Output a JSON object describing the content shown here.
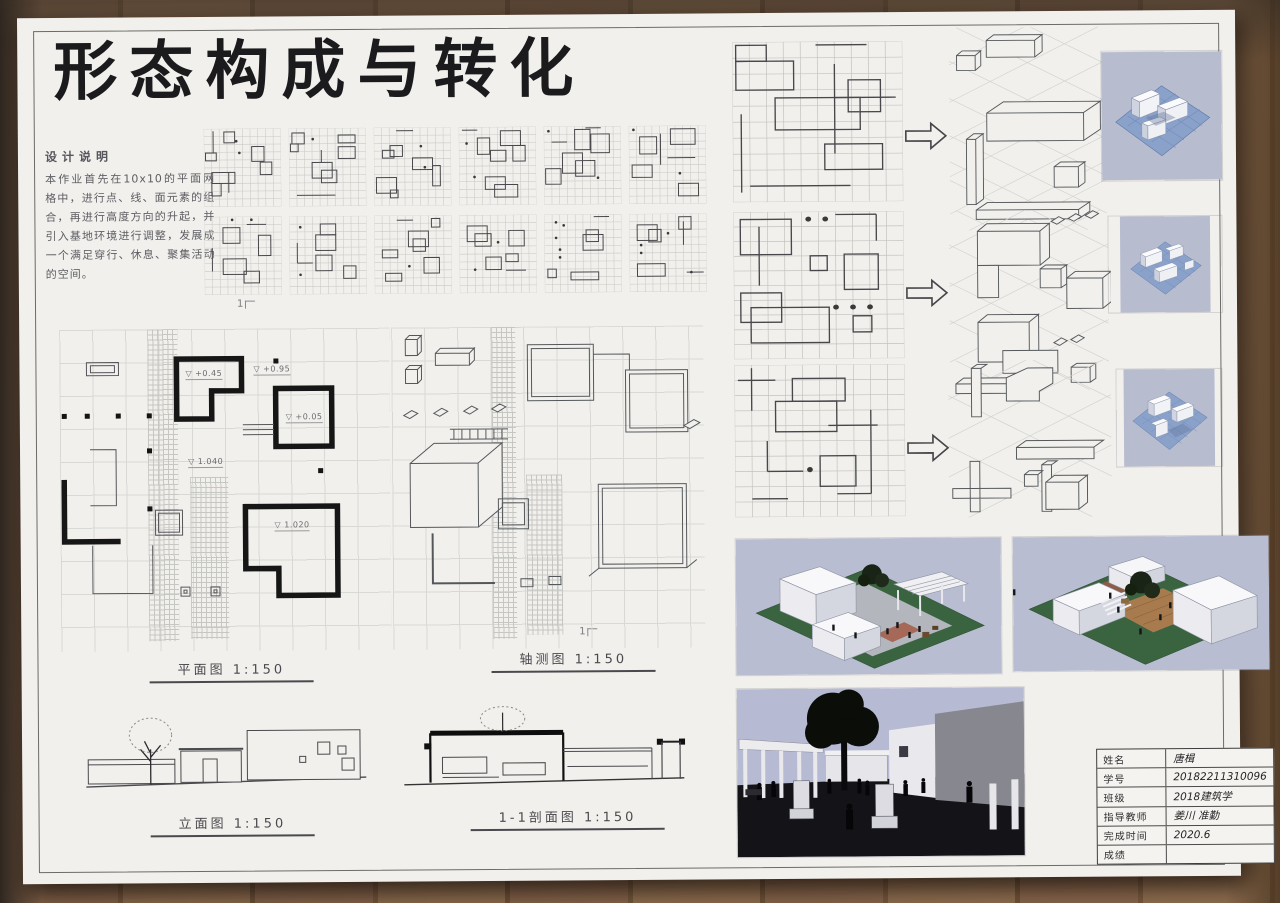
{
  "title": "形态构成与转化",
  "design_notes": {
    "heading": "设计说明",
    "body": "本作业首先在10x10的平面网格中，进行点、线、面元素的组合，再进行高度方向的升起，并引入基地环境进行调整，发展成一个满足穿行、休息、聚集活动的空间。"
  },
  "labels": {
    "plan": "平面图 1:150",
    "axon": "轴测图 1:150",
    "elevation": "立面图 1:150",
    "section": "1-1剖面图 1:150"
  },
  "plan": {
    "level_symbol": "▽",
    "section_marker": "1",
    "annotations": [
      {
        "text": "+0.45",
        "x": 126,
        "y": 40
      },
      {
        "text": "+0.95",
        "x": 194,
        "y": 36
      },
      {
        "text": "+0.05",
        "x": 226,
        "y": 84
      },
      {
        "text": "1.040",
        "x": 128,
        "y": 128
      },
      {
        "text": "1.020",
        "x": 214,
        "y": 192
      }
    ]
  },
  "title_block": {
    "rows": [
      {
        "label": "姓名",
        "value": "唐楫"
      },
      {
        "label": "学号",
        "value": "20182211310096"
      },
      {
        "label": "班级",
        "value": "2018建筑学"
      },
      {
        "label": "指导教师",
        "value": "姜川  准勤"
      },
      {
        "label": "完成时间",
        "value": "2020.6"
      },
      {
        "label": "成绩",
        "value": ""
      }
    ]
  },
  "grid_studies": {
    "rows": [
      [
        {
          "rects": [
            [
              2.6,
              0.4,
              1.4,
              1.4
            ],
            [
              0.2,
              3.1,
              1.4,
              1
            ],
            [
              6.2,
              2.3,
              1.6,
              1.9
            ],
            [
              7.3,
              4.3,
              1.5,
              1.6
            ],
            [
              1,
              5.6,
              3,
              1.4
            ],
            [
              1,
              7,
              1.2,
              1.6
            ]
          ],
          "dots": [
            [
              4.2,
              1.6
            ],
            [
              4.6,
              3.1
            ]
          ],
          "lines": [
            [
              1.2,
              0.3,
              1.2,
              3.1
            ],
            [
              3.2,
              5.6,
              3.2,
              8.2
            ]
          ]
        },
        {
          "rects": [
            [
              0.4,
              0.6,
              1.6,
              1.4
            ],
            [
              0.2,
              2,
              1,
              1
            ],
            [
              6.4,
              0.9,
              2.2,
              1
            ],
            [
              6.4,
              2.4,
              2.2,
              1.5
            ],
            [
              3,
              4.4,
              2.6,
              2
            ],
            [
              4.2,
              5.4,
              2,
              1.6
            ]
          ],
          "dots": [
            [
              3.1,
              1.4
            ]
          ],
          "lines": [
            [
              1,
              8.6,
              6,
              8.6
            ],
            [
              4.2,
              2.8,
              4.2,
              4.4
            ]
          ]
        },
        {
          "rects": [
            [
              2.1,
              2.3,
              1.6,
              1.4
            ],
            [
              1.1,
              2.9,
              1.5,
              1
            ],
            [
              5,
              3.9,
              2.6,
              1.5
            ],
            [
              7.6,
              4.9,
              1,
              2.6
            ],
            [
              0.3,
              6.4,
              2.6,
              2
            ],
            [
              2.1,
              8,
              1,
              1
            ]
          ],
          "dots": [
            [
              6.1,
              2.4
            ],
            [
              6.6,
              5.1
            ]
          ],
          "lines": [
            [
              2.9,
              0.4,
              5.1,
              0.4
            ]
          ]
        },
        {
          "rects": [
            [
              5.4,
              0.5,
              2.6,
              1.9
            ],
            [
              2.4,
              1.4,
              1.6,
              2.1
            ],
            [
              4.1,
              3,
              2,
              1.4
            ],
            [
              7,
              2.4,
              1.6,
              2
            ],
            [
              3.4,
              6.4,
              2.6,
              1.6
            ],
            [
              4.6,
              7.4,
              3,
              1.6
            ]
          ],
          "dots": [
            [
              1,
              2.1
            ],
            [
              2,
              6.4
            ]
          ],
          "lines": [
            [
              0.4,
              0.4,
              2.4,
              0.4
            ]
          ]
        },
        {
          "rects": [
            [
              4,
              0.4,
              2,
              2.6
            ],
            [
              6.1,
              1,
              2.4,
              2.4
            ],
            [
              2.4,
              3.4,
              2.6,
              2.6
            ],
            [
              4.1,
              4.4,
              2.5,
              2
            ],
            [
              0.2,
              5.4,
              2,
              2
            ]
          ],
          "dots": [
            [
              0.6,
              0.6
            ],
            [
              7,
              6.6
            ]
          ],
          "lines": [
            [
              1,
              2,
              3,
              2
            ],
            [
              5.4,
              0.2,
              7.4,
              0.2
            ]
          ]
        },
        {
          "rects": [
            [
              5.4,
              0.4,
              3.2,
              2
            ],
            [
              1.4,
              1.4,
              2.2,
              2.2
            ],
            [
              0.4,
              5,
              2.6,
              1.6
            ],
            [
              6.4,
              7.4,
              2.6,
              1.6
            ]
          ],
          "dots": [
            [
              0.6,
              0.5
            ],
            [
              6.6,
              6.1
            ]
          ],
          "lines": [
            [
              4.1,
              1,
              4.1,
              5
            ],
            [
              5,
              4.1,
              8.6,
              4.1
            ]
          ]
        }
      ],
      [
        {
          "rects": [
            [
              2.4,
              1.4,
              2.2,
              2
            ],
            [
              7,
              2.4,
              1.6,
              2.6
            ],
            [
              2.4,
              5.4,
              3,
              2
            ],
            [
              5.1,
              7,
              2,
              1.5
            ]
          ],
          "dots": [
            [
              3.6,
              0.4
            ],
            [
              6.1,
              0.4
            ]
          ],
          "lines": [
            [
              5.5,
              1,
              8,
              1
            ],
            [
              1,
              4,
              1,
              7
            ]
          ]
        },
        {
          "rects": [
            [
              4,
              1,
              2,
              1.4
            ],
            [
              3.4,
              2.4,
              2.6,
              2
            ],
            [
              3.4,
              5,
              2.1,
              2
            ],
            [
              7,
              6.4,
              1.6,
              1.6
            ]
          ],
          "dots": [
            [
              1.4,
              1.4
            ],
            [
              1.4,
              7.5
            ]
          ],
          "lines": [
            [
              1,
              3.4,
              1,
              6
            ],
            [
              1,
              6,
              3,
              6
            ]
          ]
        },
        {
          "rects": [
            [
              7.4,
              0.4,
              1.1,
              1.1
            ],
            [
              4.4,
              2,
              2.6,
              2
            ],
            [
              5,
              3,
              1.6,
              1.6
            ],
            [
              1,
              4.4,
              2,
              1
            ],
            [
              6.4,
              5.4,
              2,
              2
            ],
            [
              1.4,
              7.4,
              2.1,
              1
            ]
          ],
          "dots": [
            [
              4.5,
              6.5
            ]
          ],
          "lines": [
            [
              2.9,
              0.6,
              5,
              0.6
            ]
          ]
        },
        {
          "rects": [
            [
              1,
              1.4,
              2.6,
              2
            ],
            [
              2,
              2.4,
              2.1,
              1.6
            ],
            [
              6.4,
              2,
              2,
              2
            ],
            [
              3.4,
              5.4,
              2,
              1.6
            ],
            [
              6,
              5,
              1.6,
              1
            ]
          ],
          "dots": [
            [
              5,
              3.5
            ],
            [
              2,
              7
            ]
          ],
          "lines": [
            [
              6,
              7.1,
              8.6,
              7.1
            ]
          ]
        },
        {
          "rects": [
            [
              5.4,
              2,
              1.6,
              1.5
            ],
            [
              5,
              2.6,
              2.6,
              2
            ],
            [
              0.4,
              7,
              1.1,
              1.1
            ],
            [
              3.4,
              7.4,
              3.6,
              1
            ]
          ],
          "dots": [
            [
              1.5,
              1
            ],
            [
              2.5,
              1.4
            ],
            [
              1.5,
              3
            ],
            [
              2,
              4.5
            ],
            [
              2,
              5.5
            ]
          ],
          "lines": [
            [
              6.4,
              0.3,
              8.4,
              0.3
            ]
          ]
        },
        {
          "rects": [
            [
              6.4,
              0.4,
              1.6,
              1.6
            ],
            [
              1,
              1.4,
              2.6,
              2
            ],
            [
              2.5,
              2,
              1.6,
              1.6
            ],
            [
              1,
              6.4,
              3.6,
              1.6
            ]
          ],
          "dots": [
            [
              1.5,
              4
            ],
            [
              1.5,
              5
            ],
            [
              5,
              2.5
            ],
            [
              8,
              7.5
            ]
          ],
          "lines": [
            [
              7.4,
              7.5,
              9.6,
              7.5
            ],
            [
              7,
              1,
              7,
              4
            ]
          ]
        }
      ]
    ]
  },
  "transform_grids": [
    {
      "rects": [
        [
          0.2,
          0.2,
          1.8,
          1
        ],
        [
          0.2,
          1.2,
          3.4,
          1.8
        ],
        [
          6.8,
          2.4,
          1.9,
          2
        ],
        [
          2.5,
          3.5,
          5,
          2
        ],
        [
          5.4,
          6.4,
          3.4,
          1.6
        ]
      ],
      "dots": [],
      "lines": [
        [
          6,
          1.4,
          6,
          7
        ],
        [
          0.5,
          4.5,
          0.5,
          9.4
        ],
        [
          1,
          9,
          6.9,
          9
        ],
        [
          4.9,
          0.2,
          7.9,
          0.2
        ],
        [
          6,
          3.5,
          9.6,
          3.5
        ]
      ]
    },
    {
      "rects": [
        [
          0.4,
          0.5,
          3,
          2.4
        ],
        [
          4.5,
          3,
          1,
          1
        ],
        [
          6.5,
          2.9,
          2,
          2.4
        ],
        [
          0.4,
          5.5,
          2.4,
          2
        ],
        [
          1,
          6.5,
          4.6,
          2.4
        ],
        [
          7,
          7.1,
          1.1,
          1.1
        ]
      ],
      "dots": [
        [
          4.4,
          0.5
        ],
        [
          5.4,
          0.5
        ],
        [
          6,
          6.5
        ],
        [
          7,
          6.5
        ],
        [
          8,
          6.5
        ]
      ],
      "lines": [
        [
          1.5,
          1,
          1.5,
          5
        ],
        [
          6,
          0.2,
          8.4,
          0.2
        ],
        [
          8.4,
          0.2,
          8.4,
          2
        ]
      ]
    },
    {
      "rects": [
        [
          3.4,
          0.9,
          3.1,
          1.5
        ],
        [
          2.4,
          2.4,
          3.6,
          2
        ],
        [
          5,
          6,
          2.1,
          2
        ]
      ],
      "dots": [
        [
          4.4,
          6.9
        ]
      ],
      "lines": [
        [
          1,
          0.2,
          1,
          3
        ],
        [
          0.2,
          1,
          2.4,
          1
        ],
        [
          8,
          3,
          8,
          8.5
        ],
        [
          5.5,
          4,
          8.4,
          4
        ],
        [
          1.9,
          5,
          1.9,
          7
        ],
        [
          1,
          8.8,
          3.1,
          8.8
        ],
        [
          1.9,
          7,
          4,
          7
        ],
        [
          8,
          8.5,
          6,
          8.5
        ]
      ]
    }
  ],
  "colors": {
    "poster": "#f1f0ed",
    "wood": "#85654a",
    "ink": "#1b1b1d",
    "paper_grid_line": "#d8d8d5",
    "render_sky": "#b8bcd2",
    "render_grass": "#3a6340",
    "render_base_blue": "#8aa2ca",
    "brick_paving": "#9c5a46"
  }
}
